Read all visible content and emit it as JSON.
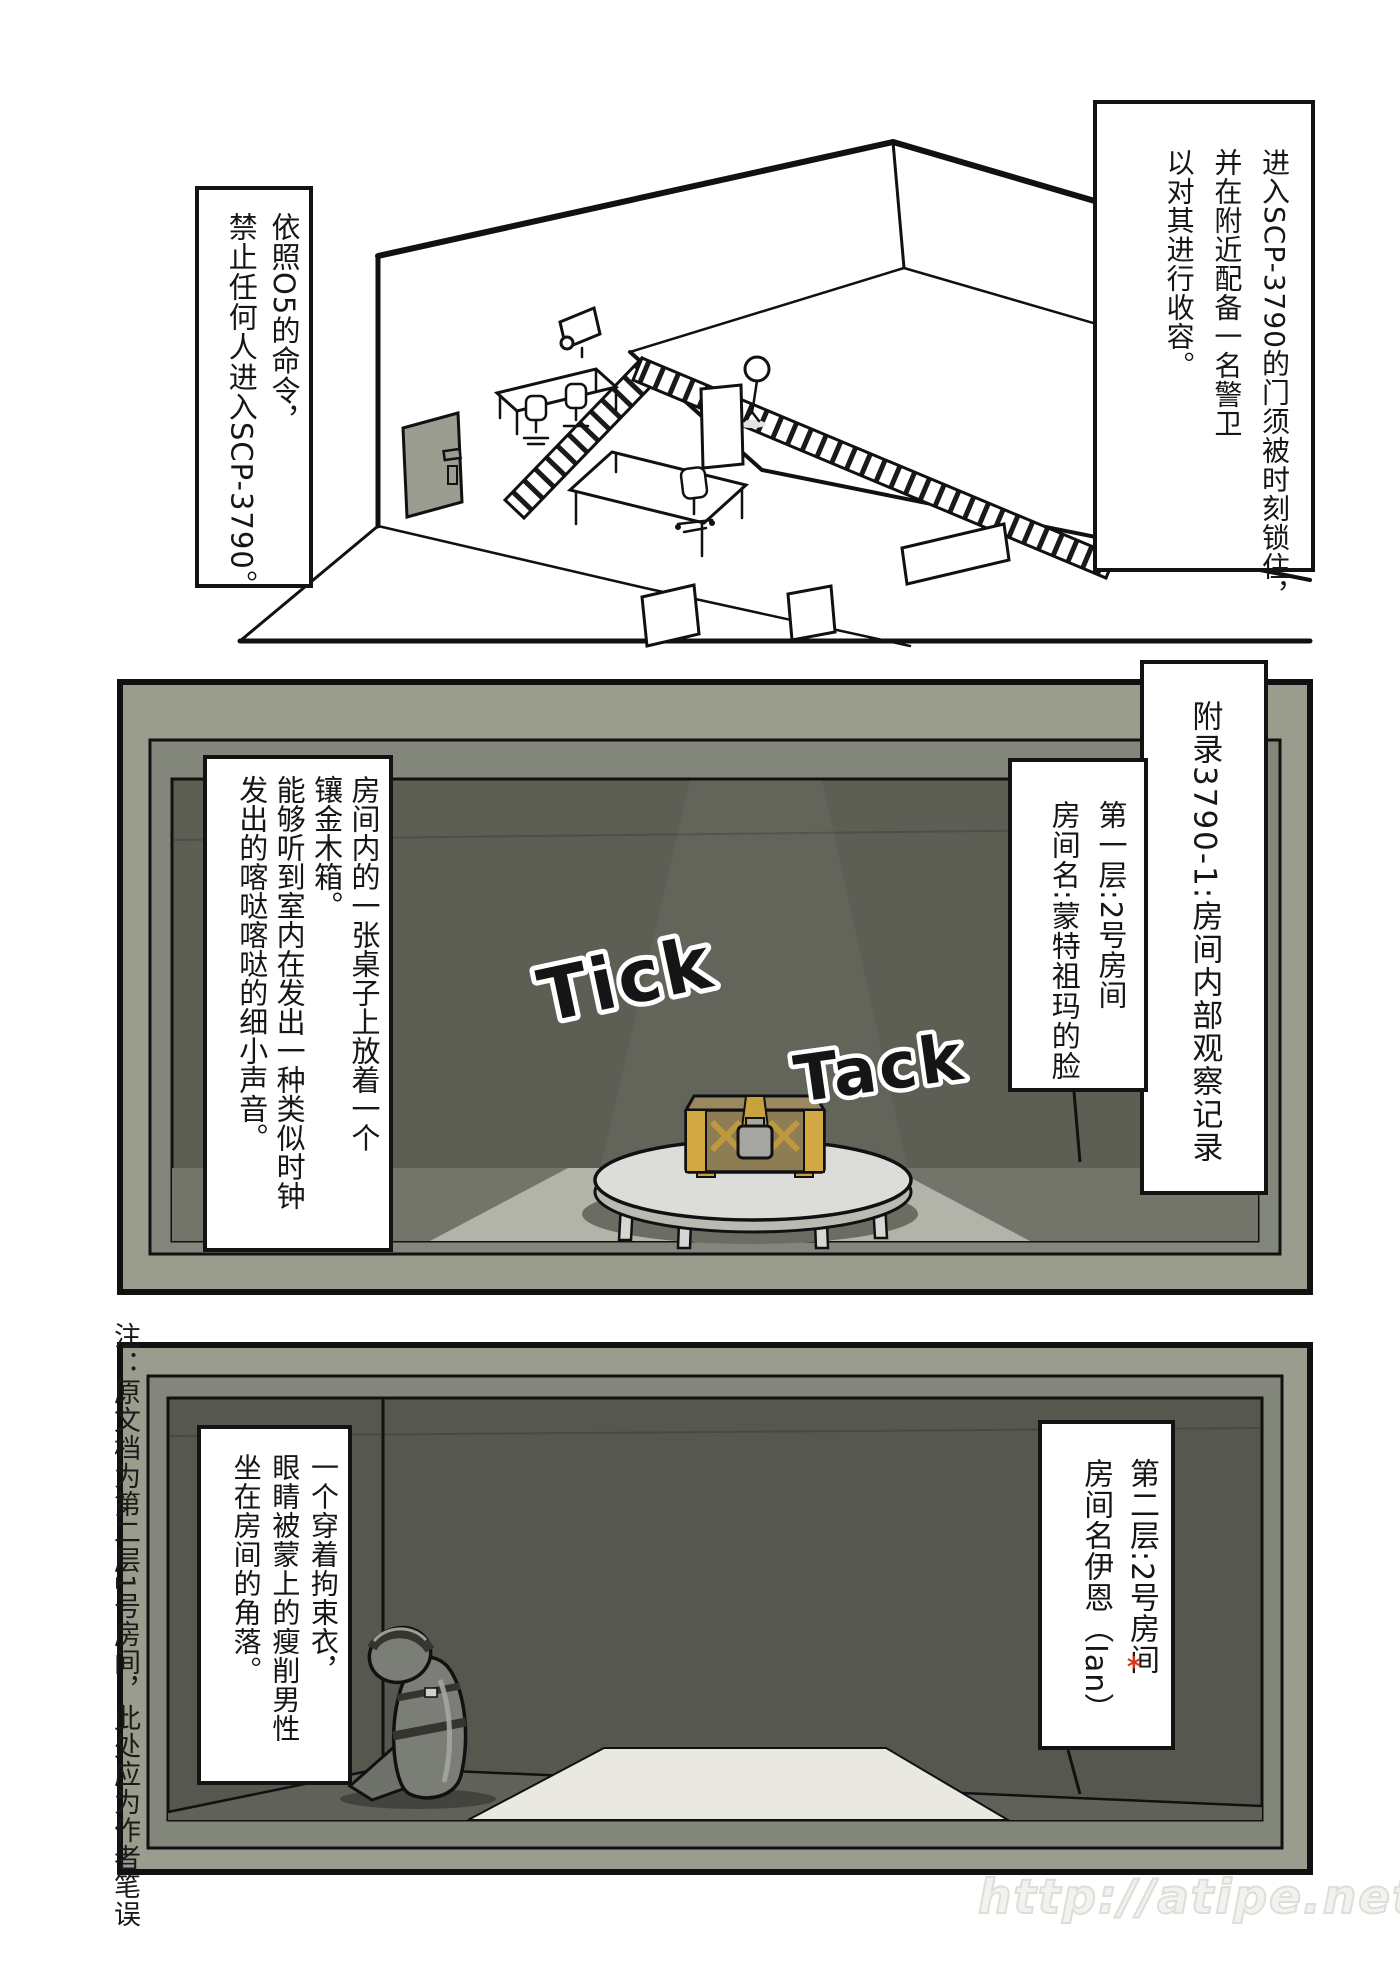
{
  "comic": {
    "panel1": {
      "caption_left": {
        "columns": [
          "依照O5的命令，",
          "禁止任何人进入SCP-3790。"
        ]
      },
      "caption_right": {
        "columns": [
          "进入SCP-3790的门须被时刻锁住，",
          "并在附近配备一名警卫",
          "以对其进行收容。"
        ]
      }
    },
    "panel2": {
      "appendix_label": "附录3790-1:房间内部观察记录",
      "room_label": {
        "columns": [
          "第一层:2号房间",
          "房间名:蒙特祖玛的脸"
        ]
      },
      "description": {
        "columns": [
          "房间内的一张桌子上放着一个",
          "镶金木箱。",
          "能够听到室内在发出一种类似时钟",
          "发出的喀哒喀哒的细小声音。"
        ]
      },
      "sfx": {
        "tick": "Tick",
        "tack": "Tack"
      }
    },
    "panel3": {
      "room_label": {
        "columns": [
          "第二层:2号房间",
          "房间名伊恩（Ian）"
        ],
        "footnote_marker": "*"
      },
      "description": {
        "columns": [
          "一个穿着拘束衣，",
          "眼睛被蒙上的瘦削男性",
          "坐在房间的角落。"
        ]
      }
    },
    "margin_note": "注：原文档为第二层1号房间，此处应为作者笔误",
    "watermark": "http://atipe.net/"
  },
  "colors": {
    "panel_frame": "#9a9c8e",
    "panel_lip": "#83867a",
    "room_wall_mid": "#5d5f55",
    "room_wall_bottom": "#565850",
    "floor_light": "#b2b4aa",
    "spotlight": "#e9e9e1",
    "chest_wood": "#8d7c54",
    "chest_gold": "#d2a843",
    "door_gray": "#9b9d90",
    "figure_gray": "#7b7d77",
    "footnote_red": "#d93218"
  }
}
